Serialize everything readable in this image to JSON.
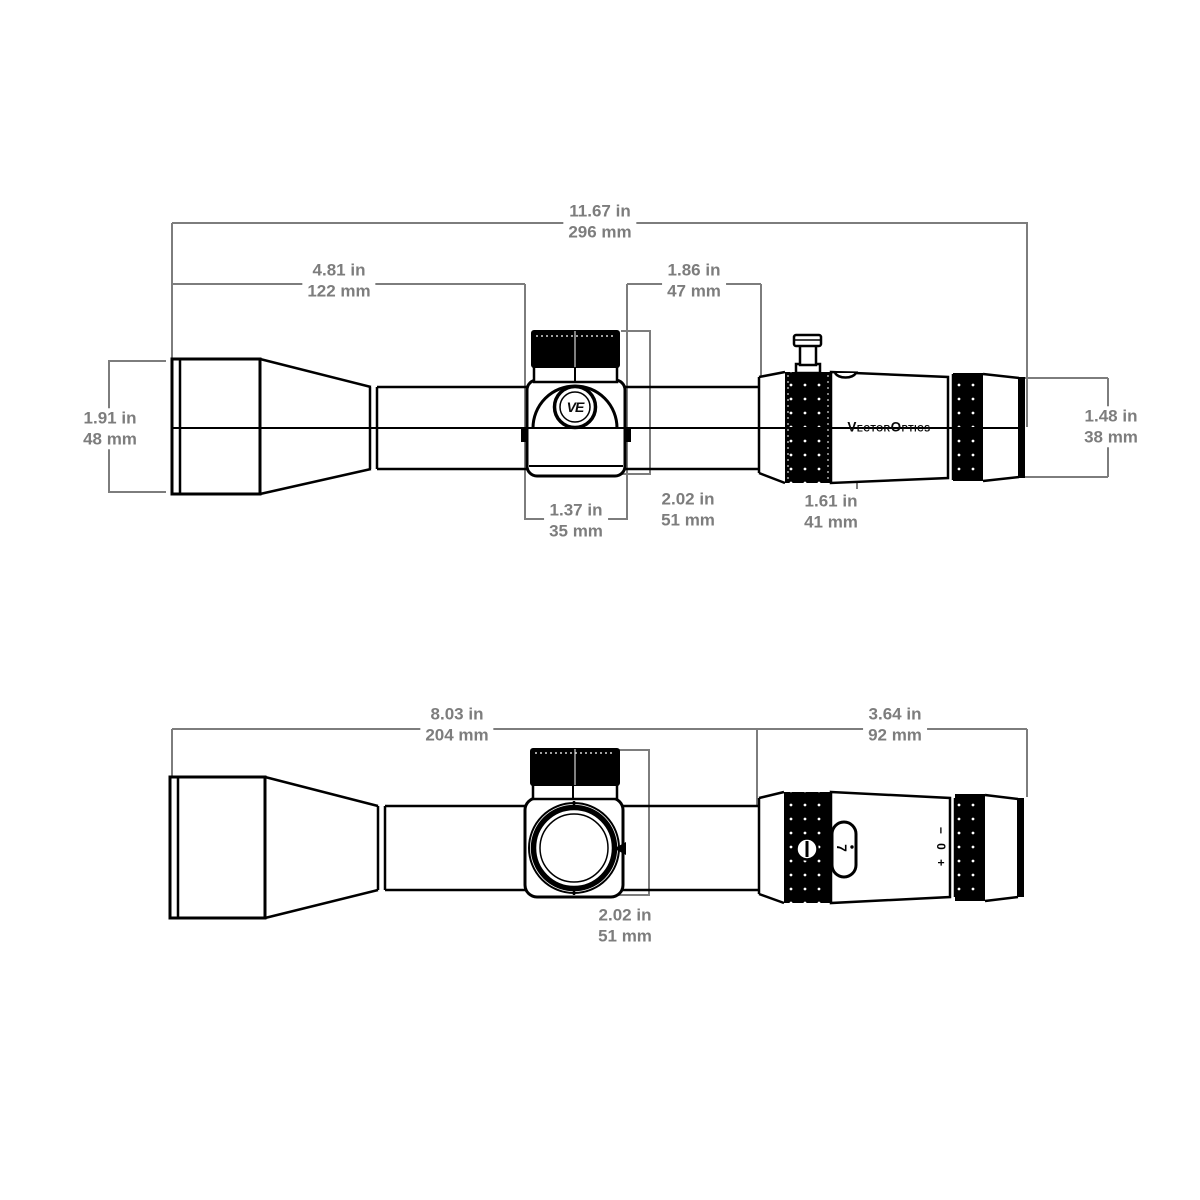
{
  "drawing": {
    "brand": {
      "wordmark": "VectorOptics",
      "monogram": "VE"
    },
    "eyepiece_markings": {
      "magnification": "7",
      "diopter": "− 0 +"
    },
    "dims": {
      "overall": {
        "in": "11.67 in",
        "mm": "296 mm"
      },
      "front": {
        "in": "4.81 in",
        "mm": "122 mm"
      },
      "mid": {
        "in": "1.86 in",
        "mm": "47 mm"
      },
      "objective": {
        "in": "1.91 in",
        "mm": "48 mm"
      },
      "saddle": {
        "in": "1.37 in",
        "mm": "35 mm"
      },
      "height": {
        "in": "2.02 in",
        "mm": "51 mm"
      },
      "magring": {
        "in": "1.61 in",
        "mm": "41 mm"
      },
      "ocular": {
        "in": "1.48 in",
        "mm": "38 mm"
      },
      "bottom_front": {
        "in": "8.03 in",
        "mm": "204 mm"
      },
      "bottom_rear": {
        "in": "3.64 in",
        "mm": "92 mm"
      },
      "bottom_saddle": {
        "in": "2.02 in",
        "mm": "51 mm"
      }
    },
    "colors": {
      "line": "#000000",
      "dimension": "#7d7d7d",
      "background": "#ffffff"
    }
  }
}
